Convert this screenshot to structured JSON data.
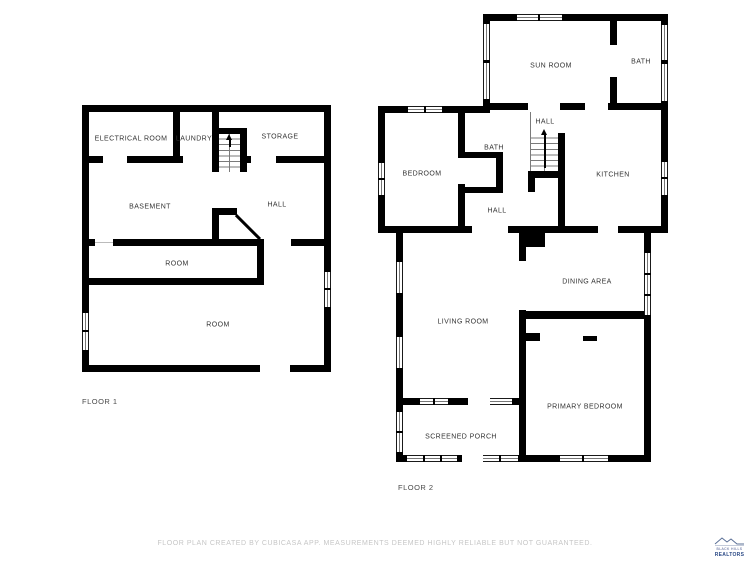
{
  "floors": [
    {
      "name": "FLOOR 1",
      "rooms": [
        {
          "label": "ELECTRICAL ROOM"
        },
        {
          "label": "LAUNDRY"
        },
        {
          "label": "STORAGE"
        },
        {
          "label": "BASEMENT"
        },
        {
          "label": "HALL"
        },
        {
          "label": "ROOM"
        },
        {
          "label": "ROOM"
        }
      ]
    },
    {
      "name": "FLOOR 2",
      "rooms": [
        {
          "label": "SUN ROOM"
        },
        {
          "label": "BATH"
        },
        {
          "label": "BEDROOM"
        },
        {
          "label": "BATH"
        },
        {
          "label": "HALL"
        },
        {
          "label": "KITCHEN"
        },
        {
          "label": "HALL"
        },
        {
          "label": "DINING AREA"
        },
        {
          "label": "LIVING ROOM"
        },
        {
          "label": "PRIMARY BEDROOM"
        },
        {
          "label": "SCREENED PORCH"
        }
      ]
    }
  ],
  "footer": {
    "disclaimer": "FLOOR PLAN CREATED BY CUBICASA APP. MEASUREMENTS DEEMED HIGHLY RELIABLE BUT NOT GUARANTEED."
  },
  "logo": {
    "line1": "BLACK HILLS",
    "line2": "REALTORS"
  },
  "colors": {
    "wall": "#000000",
    "label": "#333333",
    "floor_label": "#4a4a4a",
    "disclaimer": "#c6c6c6",
    "logo_navy": "#2b4a86"
  }
}
